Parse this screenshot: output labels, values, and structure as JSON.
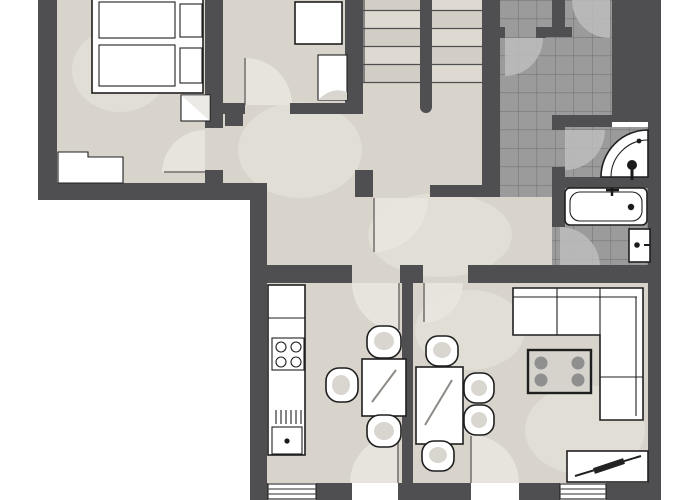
{
  "meta": {
    "type": "apartment-floor-plan",
    "style": "2d-top-down",
    "text_labels": "none"
  },
  "colors": {
    "background": "#ffffff",
    "wall": "#4f4e50",
    "floor": "#d8d4cc",
    "floor_light": "#e9e6df",
    "tile": "#9b9b9b",
    "tile_line": "#767676",
    "tile_light": "#bdbdbd",
    "outline": "#1f1f1f",
    "furniture": "#ffffff",
    "furniture_shade": "#d9d6d0",
    "table_top": "#d6d3cc",
    "dot": "#8f8f8f"
  },
  "rooms": [
    {
      "name": "bedroom",
      "floor": "screed",
      "fixtures": [
        "double-bed",
        "two-mattresses",
        "two-pillows",
        "nightstand",
        "dresser"
      ]
    },
    {
      "name": "study",
      "floor": "screed",
      "fixtures": [
        "desk",
        "cabinet"
      ]
    },
    {
      "name": "staircase",
      "floor": "screed",
      "fixtures": [
        "two-flights",
        "center-wall",
        "ten-treads"
      ]
    },
    {
      "name": "entrance-hall",
      "floor": "tiles",
      "fixtures": [
        "two-entry-doors"
      ]
    },
    {
      "name": "corridor",
      "floor": "screed",
      "fixtures": [
        "inner-door"
      ]
    },
    {
      "name": "shower-room",
      "floor": "tiles",
      "fixtures": [
        "corner-shower"
      ]
    },
    {
      "name": "bathroom",
      "floor": "tiles",
      "fixtures": [
        "bathtub",
        "wash-basin"
      ]
    },
    {
      "name": "kitchen",
      "floor": "screed",
      "fixtures": [
        "counter",
        "cooktop-4-burners",
        "sink",
        "drainer",
        "table",
        "three-chairs",
        "balcony-door",
        "window"
      ]
    },
    {
      "name": "dining-area",
      "floor": "screed",
      "fixtures": [
        "table",
        "four-chairs"
      ]
    },
    {
      "name": "living-room",
      "floor": "screed",
      "fixtures": [
        "corner-sofa",
        "coffee-table",
        "tv-board",
        "balcony-door",
        "window"
      ]
    }
  ]
}
